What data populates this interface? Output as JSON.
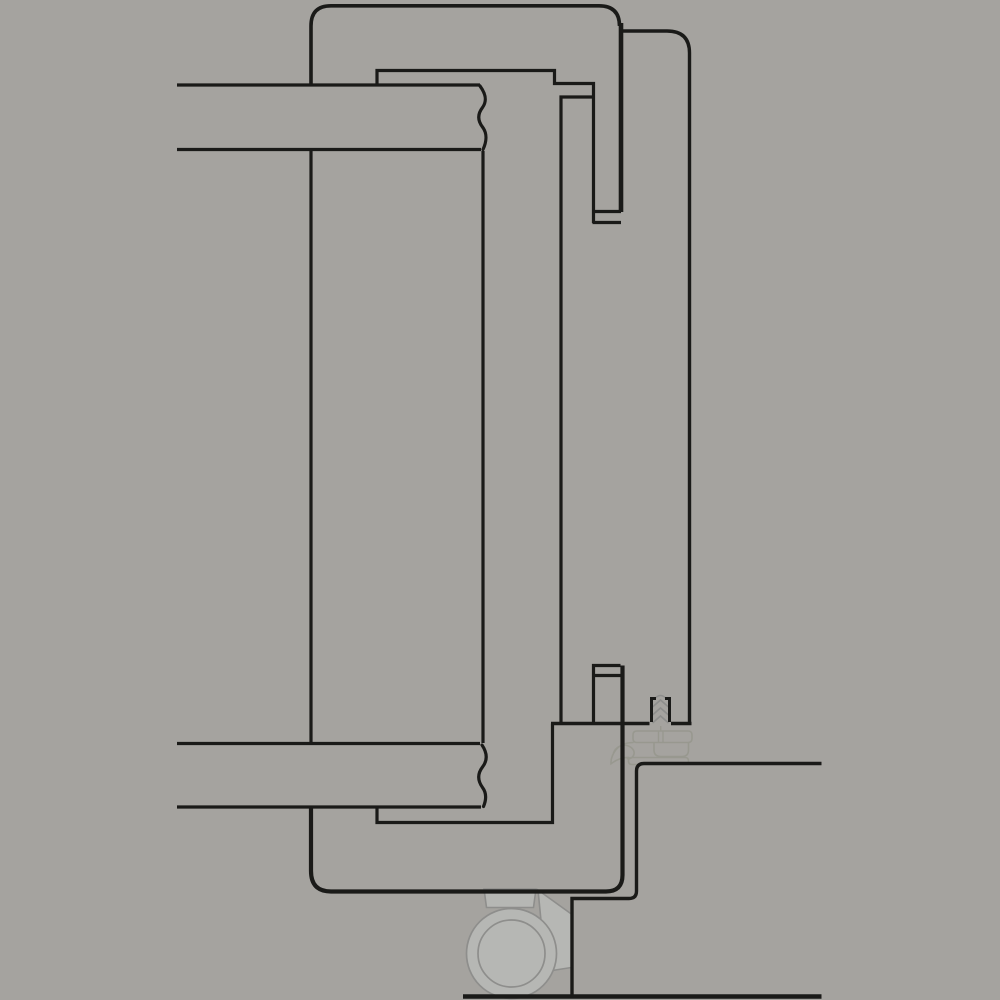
{
  "meta": {
    "title": "Door frame profile section detail drawing",
    "canvas": {
      "width": 1000,
      "height": 1000
    }
  },
  "colors": {
    "background": "#a5a39f",
    "line": "#1a1a18",
    "ghost_fill": "#b6b7b4",
    "ghost_stroke": "#8e8e8c",
    "seal_stroke": "#98988f"
  },
  "shapes": [
    {
      "name": "hinge-stem",
      "type": "path",
      "d": "M 484,889 L 536,889 L 533.5,907.5 L 486.5,907.5 Z",
      "stroke": "ghost_stroke",
      "width": 1.6,
      "fill": "ghost_fill",
      "cap": "butt"
    },
    {
      "name": "hinge-wedge",
      "type": "path",
      "d": "M 538,890 L 571.3,914 L 571.3,967.5 L 546,971.5 Z",
      "stroke": "ghost_stroke",
      "width": 1.6,
      "fill": "ghost_fill",
      "cap": "butt"
    },
    {
      "name": "roller-outer-circle",
      "type": "circle",
      "cx": 511.5,
      "cy": 953.5,
      "r": 45,
      "stroke": "ghost_stroke",
      "width": 1.7,
      "fill": "ghost_fill"
    },
    {
      "name": "roller-inner-circle",
      "type": "circle",
      "cx": 511.5,
      "cy": 953.5,
      "r": 33.5,
      "stroke": "ghost_stroke",
      "width": 1.7,
      "fill": "none"
    },
    {
      "name": "seal-plate",
      "type": "path",
      "d": "M 637,731 L 688,731 Q 692,731 692,735 L 692,738.5 Q 692,742.5 688,742.5 L 637,742.5 Q 633,742.5 633,738.5 L 633,735 Q 633,731 637,731 Z",
      "stroke": "seal_stroke",
      "width": 1.6,
      "fill": "none",
      "cap": "butt"
    },
    {
      "name": "seal-screw-tip",
      "type": "path",
      "d": "M 658.5,731 L 658.5,742.5 M 663,731 L 663,742.5 M 660.7,726 L 660.7,731",
      "stroke": "seal_stroke",
      "width": 1.4,
      "fill": "none",
      "cap": "butt"
    },
    {
      "name": "seal-tray",
      "type": "path",
      "d": "M 654,742.5 L 654,750 Q 654,756.5 661,756.5 L 682,756.5 Q 688.5,756.5 688.5,750 L 688.5,742.5",
      "stroke": "seal_stroke",
      "width": 1.6,
      "fill": "none",
      "cap": "butt"
    },
    {
      "name": "seal-lip",
      "type": "path",
      "d": "M 632,757.5 L 685,757.5 Q 688.5,757.5 688.5,761 Q 688.5,764.5 685,764.5 L 632,764.5 Q 628.5,764.5 628.5,761 Q 628.5,757.5 632,757.5 Z",
      "stroke": "seal_stroke",
      "width": 1.6,
      "fill": "none",
      "cap": "butt"
    },
    {
      "name": "seal-curl",
      "type": "path",
      "d": "M 633,742.5 C 623,742.5 616,747.5 612.5,755.5 C 611.3,758.3 610.8,761 611,763.8 C 616.5,759.5 622.5,757.3 629,757.5 M 613.5,753 C 615.5,747.5 621.5,744 627,745.5 C 632.5,747 635.5,751.5 633.5,755.5 C 632.3,757.8 630,759 627.5,758.8",
      "stroke": "seal_stroke",
      "width": 1.6,
      "fill": "none",
      "cap": "round"
    },
    {
      "name": "screw-thread-zigzag",
      "type": "path",
      "d": "M 654,699.5 Q 660.5,691.5 667,699.5 M 652.5,707 L 660.5,700 L 668.5,707 M 652.5,715 L 660.5,708 L 668.5,715 M 652.5,723 L 660.5,716 L 668.5,723",
      "stroke": "ghost_stroke",
      "width": 1.6,
      "fill": "none",
      "cap": "butt"
    },
    {
      "name": "outer-frame-top",
      "type": "path",
      "d": "M 311,85 L 311,26 Q 311,5.8 331,5.8 L 599,5.8 Q 619.5,5.8 619.5,26",
      "stroke": "line",
      "width": 3.6,
      "fill": "none",
      "cap": "butt"
    },
    {
      "name": "frame-right-merged-top",
      "type": "path",
      "d": "M 621,23 L 621,212",
      "stroke": "line",
      "width": 4.6,
      "fill": "none",
      "cap": "butt"
    },
    {
      "name": "outer-frame-left-mid",
      "type": "path",
      "d": "M 311,150 L 311,743",
      "stroke": "line",
      "width": 3.2,
      "fill": "none",
      "cap": "butt"
    },
    {
      "name": "outer-frame-bottom",
      "type": "path",
      "d": "M 311,808 L 311,871 Q 311,891.5 331,891.5 L 606,891.5 Q 622.5,891.5 622.5,875 L 622.5,665.5",
      "stroke": "line",
      "width": 4.2,
      "fill": "none",
      "cap": "butt"
    },
    {
      "name": "second-frame-profile",
      "type": "path",
      "d": "M 622,31 L 667,31 Q 689.5,31 689.5,53 L 689.5,722",
      "stroke": "line",
      "width": 3.4,
      "fill": "none",
      "cap": "butt"
    },
    {
      "name": "top-inner-profile",
      "type": "path",
      "d": "M 377,85 L 377,70.5 L 554.5,70.5 L 554.5,83.5 L 593.5,83.5 L 593.5,223",
      "stroke": "line",
      "width": 3.2,
      "fill": "none",
      "cap": "butt"
    },
    {
      "name": "top-anchor-cap",
      "type": "path",
      "d": "M 592.5,222.5 L 621,222.5 M 592.5,211.5 L 621,211.5",
      "stroke": "line",
      "width": 3.2,
      "fill": "none",
      "cap": "butt"
    },
    {
      "name": "inner-channel",
      "type": "path",
      "d": "M 593.5,97 L 561,97 L 561,723",
      "stroke": "line",
      "width": 3.2,
      "fill": "none",
      "cap": "butt"
    },
    {
      "name": "top-band-lines",
      "type": "path",
      "d": "M 177,85 L 480,85 M 177,149.5 L 481,149.5",
      "stroke": "line",
      "width": 3.2,
      "fill": "none",
      "cap": "butt"
    },
    {
      "name": "top-band-break",
      "type": "path",
      "d": "M 480,86 C 485.5,93.5 487.5,100.5 482.5,107.5 C 477.5,114 477.5,120.5 482.5,127 C 487.5,133.5 486.5,142 483,149.5",
      "stroke": "line",
      "width": 3.2,
      "fill": "none",
      "cap": "round"
    },
    {
      "name": "leaf-edge-line",
      "type": "path",
      "d": "M 483,151 L 483,743",
      "stroke": "line",
      "width": 3.2,
      "fill": "none",
      "cap": "butt"
    },
    {
      "name": "bottom-band-lines",
      "type": "path",
      "d": "M 177,743.5 L 480,743.5 M 177,807 L 481,807",
      "stroke": "line",
      "width": 3.2,
      "fill": "none",
      "cap": "butt"
    },
    {
      "name": "bottom-band-break",
      "type": "path",
      "d": "M 482,745 C 487,752.5 488,760 482.5,767 C 477.5,773.5 477.5,780.5 482.5,787.5 C 487,793.5 486,800.5 483.5,806.5",
      "stroke": "line",
      "width": 3.2,
      "fill": "none",
      "cap": "round"
    },
    {
      "name": "bottom-inner-profile",
      "type": "path",
      "d": "M 377,808 L 377,822.5 L 552.5,822.5 L 552.5,723.5",
      "stroke": "line",
      "width": 3.2,
      "fill": "none",
      "cap": "butt"
    },
    {
      "name": "rebate-line",
      "type": "path",
      "d": "M 551,723.5 L 649.5,723.5 M 671,723.5 L 691.5,723.5",
      "stroke": "line",
      "width": 3.6,
      "fill": "none",
      "cap": "butt"
    },
    {
      "name": "bottom-anchor-hook",
      "type": "path",
      "d": "M 593.5,722 L 593.5,665.5 L 620.5,665.5 M 592,675.5 L 620.5,675.5",
      "stroke": "line",
      "width": 3.2,
      "fill": "none",
      "cap": "butt"
    },
    {
      "name": "screw-channel-walls",
      "type": "path",
      "d": "M 651.5,722 L 651.5,698.5 L 656,698.5 M 669.5,722 L 669.5,698.5 L 665,698.5",
      "stroke": "line",
      "width": 3.0,
      "fill": "none",
      "cap": "butt"
    },
    {
      "name": "floor-step",
      "type": "path",
      "d": "M 572,995 L 572,898.5 L 629,898.5 Q 636.5,898.5 636.5,891 L 636.5,771 Q 636.5,763.5 644,763.5 L 821.5,763.5",
      "stroke": "line",
      "width": 3.4,
      "fill": "none",
      "cap": "butt"
    },
    {
      "name": "floor-bottom-line",
      "type": "path",
      "d": "M 463,996.5 L 821.5,996.5",
      "stroke": "line",
      "width": 4.5,
      "fill": "none",
      "cap": "butt"
    }
  ]
}
